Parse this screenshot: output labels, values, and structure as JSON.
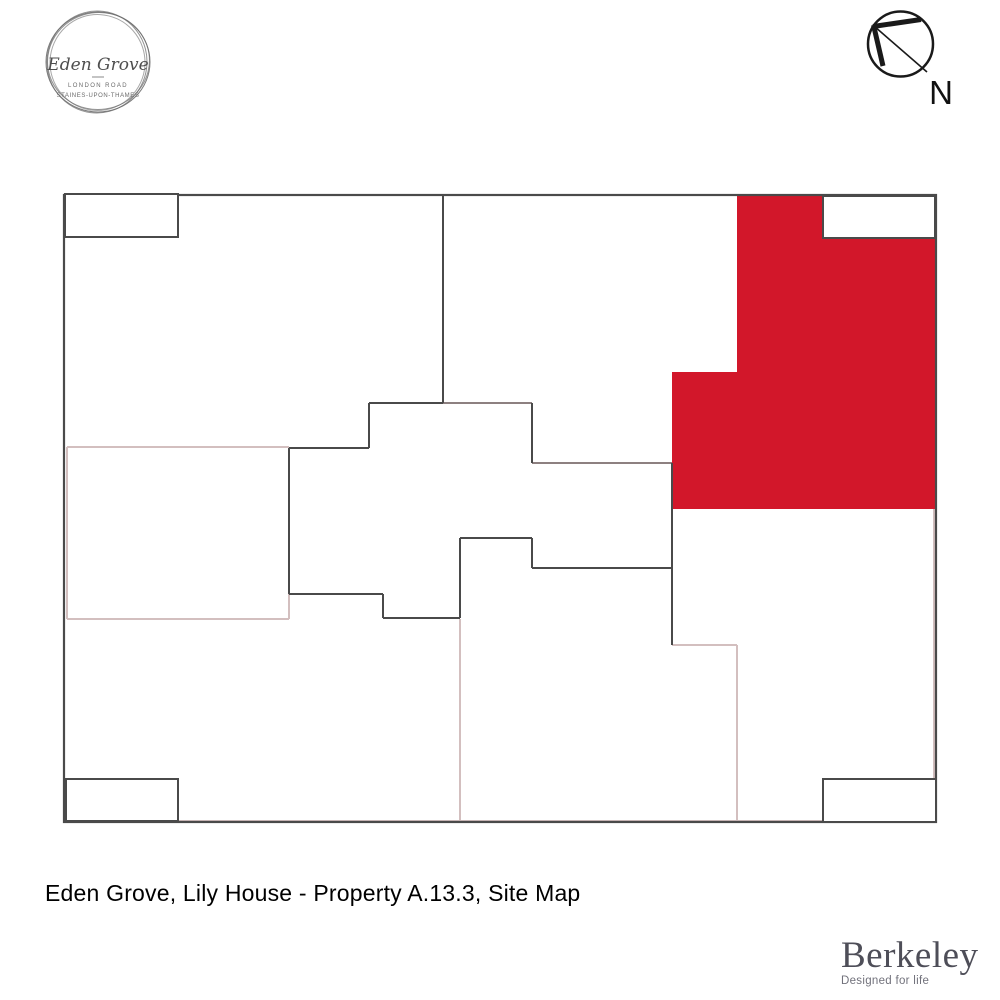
{
  "brand_logo": {
    "name": "Eden Grove",
    "line1": "LONDON ROAD",
    "line2": "STAINES-UPON-THAMES"
  },
  "compass": {
    "label": "N"
  },
  "caption": "Eden Grove, Lily House - Property A.13.3, Site Map",
  "footer_logo": {
    "name": "Berkeley",
    "tagline": "Designed for life"
  },
  "colors": {
    "highlight_red": "#d2172a",
    "dark_line": "#4a4a4a",
    "mid_line": "#8d8080",
    "pink_line": "#d3bfbf",
    "white": "#ffffff"
  },
  "site_map": {
    "border": {
      "x": 64,
      "y": 195,
      "w": 872,
      "h": 627
    },
    "highlighted_property": {
      "label": "Lily House - Property A.13.3",
      "polygon": [
        [
          737,
          196
        ],
        [
          823,
          196
        ],
        [
          823,
          238
        ],
        [
          935,
          238
        ],
        [
          935,
          509
        ],
        [
          672,
          509
        ],
        [
          672,
          372
        ],
        [
          737,
          372
        ]
      ]
    },
    "corner_rects": [
      {
        "x": 65,
        "y": 194,
        "w": 113,
        "h": 43
      },
      {
        "x": 823,
        "y": 196,
        "w": 112,
        "h": 42
      },
      {
        "x": 66,
        "y": 779,
        "w": 112,
        "h": 42
      },
      {
        "x": 823,
        "y": 779,
        "w": 113,
        "h": 43
      }
    ],
    "dark_lines": [
      [
        443,
        195,
        443,
        403
      ],
      [
        369,
        403,
        443,
        403
      ],
      [
        369,
        403,
        369,
        448
      ],
      [
        289,
        448,
        369,
        448
      ],
      [
        289,
        448,
        289,
        594
      ],
      [
        289,
        594,
        383,
        594
      ],
      [
        383,
        594,
        383,
        618
      ],
      [
        383,
        618,
        460,
        618
      ],
      [
        460,
        538,
        460,
        618
      ],
      [
        460,
        538,
        532,
        538
      ],
      [
        532,
        538,
        532,
        568
      ],
      [
        532,
        568,
        672,
        568
      ],
      [
        672,
        463,
        672,
        645
      ],
      [
        532,
        403,
        532,
        463
      ]
    ],
    "mid_lines": [
      [
        443,
        403,
        532,
        403
      ],
      [
        532,
        463,
        672,
        463
      ]
    ],
    "pink_lines": [
      [
        67,
        447,
        289,
        447
      ],
      [
        67,
        447,
        67,
        619
      ],
      [
        67,
        619,
        289,
        619
      ],
      [
        289,
        594,
        289,
        619
      ],
      [
        460,
        619,
        460,
        821
      ],
      [
        672,
        645,
        737,
        645
      ],
      [
        737,
        645,
        737,
        821
      ],
      [
        178,
        821,
        823,
        821
      ],
      [
        934,
        509,
        934,
        779
      ]
    ]
  }
}
